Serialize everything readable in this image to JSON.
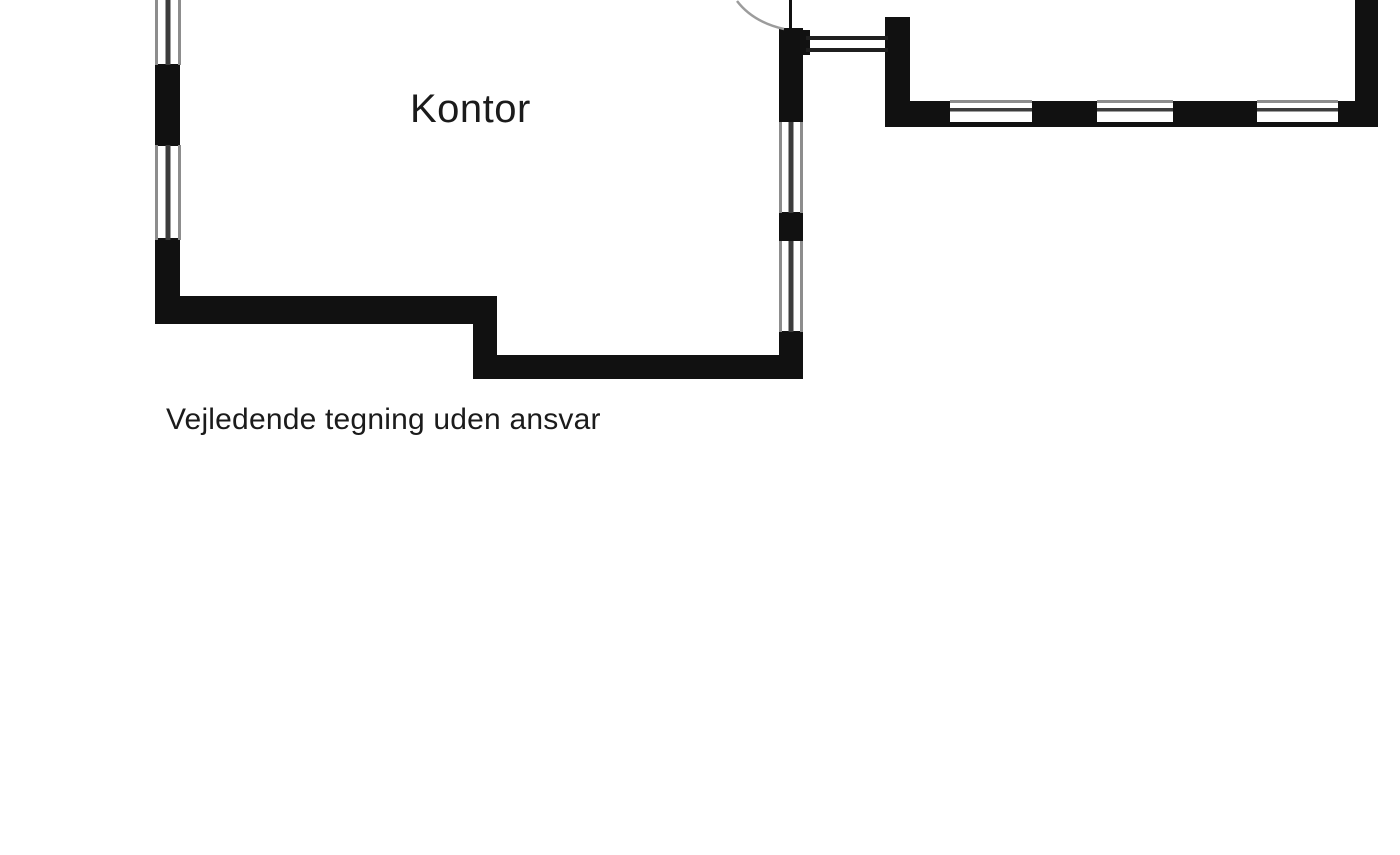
{
  "canvas": {
    "width": 1400,
    "height": 855,
    "background": "#ffffff"
  },
  "labels": {
    "room": "Kontor",
    "disclaimer": "Vejledende tegning uden ansvar"
  },
  "colors": {
    "wall": "#111111",
    "window_frame": "#8d8d8d",
    "window_glass": "#3c3c3c",
    "passage_line": "#1f1f1f",
    "door_arc": "#9c9c9c",
    "door_leaf": "#111111",
    "text": "#1b1b1b"
  },
  "plan": {
    "walls": [
      {
        "name": "west-wall-pier-upper",
        "x": 155,
        "y": 64,
        "w": 25,
        "h": 82
      },
      {
        "name": "west-wall-pier-lower",
        "x": 155,
        "y": 238,
        "w": 25,
        "h": 86
      },
      {
        "name": "south-wall-upper",
        "x": 155,
        "y": 296,
        "w": 340,
        "h": 28
      },
      {
        "name": "south-wall-step",
        "x": 473,
        "y": 296,
        "w": 24,
        "h": 83
      },
      {
        "name": "south-wall-lower",
        "x": 473,
        "y": 355,
        "w": 330,
        "h": 24
      },
      {
        "name": "east-wall-pier-top",
        "x": 779,
        "y": 28,
        "w": 24,
        "h": 94
      },
      {
        "name": "east-wall-junction-nub",
        "x": 779,
        "y": 30,
        "w": 31,
        "h": 25
      },
      {
        "name": "east-wall-pier-mid",
        "x": 779,
        "y": 212,
        "w": 24,
        "h": 29
      },
      {
        "name": "east-wall-pier-bottom",
        "x": 779,
        "y": 331,
        "w": 24,
        "h": 48
      },
      {
        "name": "annex-west-post",
        "x": 885,
        "y": 17,
        "w": 25,
        "h": 106
      },
      {
        "name": "annex-south-pier-1",
        "x": 885,
        "y": 101,
        "w": 65,
        "h": 22
      },
      {
        "name": "annex-south-pier-2",
        "x": 1032,
        "y": 101,
        "w": 65,
        "h": 22
      },
      {
        "name": "annex-south-pier-3",
        "x": 1173,
        "y": 101,
        "w": 84,
        "h": 22
      },
      {
        "name": "annex-south-pier-4",
        "x": 1338,
        "y": 101,
        "w": 40,
        "h": 22
      },
      {
        "name": "annex-south-baseline",
        "x": 885,
        "y": 122,
        "w": 493,
        "h": 5
      },
      {
        "name": "annex-east-wall",
        "x": 1355,
        "y": 0,
        "w": 23,
        "h": 123
      }
    ],
    "windows_vertical": [
      {
        "name": "window-west-upper",
        "x": 155,
        "y": 0,
        "w": 26,
        "h": 65
      },
      {
        "name": "window-west-lower",
        "x": 155,
        "y": 145,
        "w": 26,
        "h": 95
      },
      {
        "name": "window-east-upper",
        "x": 779,
        "y": 122,
        "w": 24,
        "h": 91
      },
      {
        "name": "window-east-lower",
        "x": 779,
        "y": 241,
        "w": 24,
        "h": 91
      }
    ],
    "windows_horizontal": [
      {
        "name": "window-annex-1",
        "x": 950,
        "y": 100,
        "w": 82,
        "h": 23
      },
      {
        "name": "window-annex-2",
        "x": 1097,
        "y": 100,
        "w": 76,
        "h": 23
      },
      {
        "name": "window-annex-3",
        "x": 1257,
        "y": 100,
        "w": 81,
        "h": 23
      }
    ],
    "passage_lines": [
      {
        "name": "passage-line-upper",
        "x": 806,
        "y": 36,
        "w": 82,
        "h": 4
      },
      {
        "name": "passage-line-lower",
        "x": 806,
        "y": 48,
        "w": 82,
        "h": 4
      }
    ],
    "door": {
      "leaf": {
        "x": 789,
        "y": 0,
        "w": 3,
        "h": 30
      },
      "arc_path": "M 737 1 Q 753 22 784 29"
    }
  }
}
